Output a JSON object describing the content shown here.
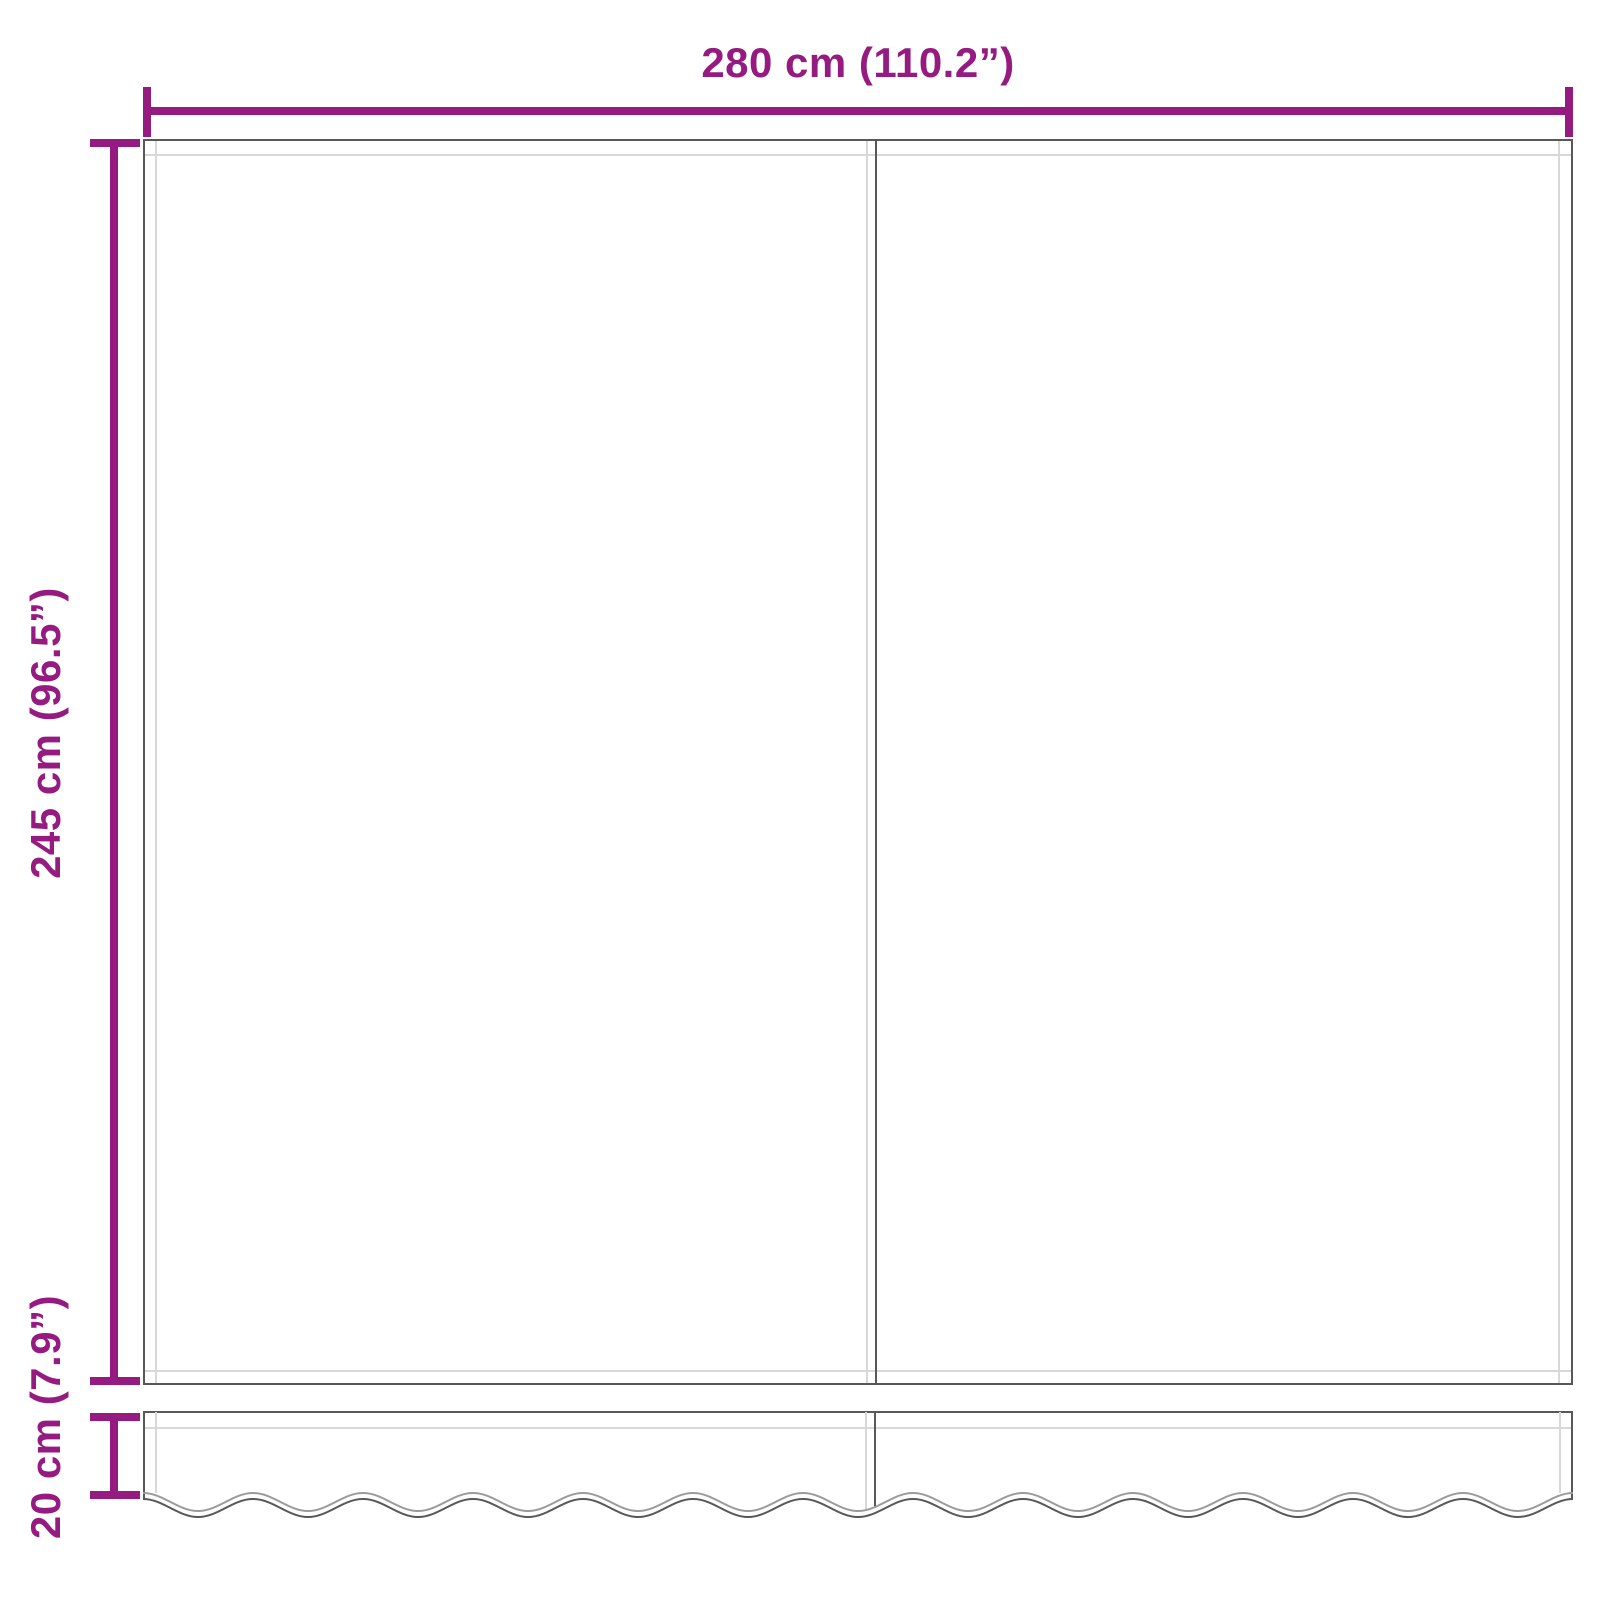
{
  "diagram": {
    "colors": {
      "accent": "#951B81",
      "outline": "#58585A",
      "seam": "#D8D8D8",
      "scallop_light": "#9B9B9B",
      "background": "#FFFFFF"
    },
    "dimensions": [
      {
        "id": "width",
        "label": "280 cm (110.2”)",
        "value_cm": 280,
        "value_inch": 110.2,
        "orientation": "horizontal",
        "measures": "fabric width"
      },
      {
        "id": "height",
        "label": "245 cm (96.5”)",
        "value_cm": 245,
        "value_inch": 96.5,
        "orientation": "vertical",
        "measures": "fabric height"
      },
      {
        "id": "valance_height",
        "label": "20 cm (7.9”)",
        "value_cm": 20,
        "value_inch": 7.9,
        "orientation": "vertical",
        "measures": "valance height"
      }
    ]
  }
}
